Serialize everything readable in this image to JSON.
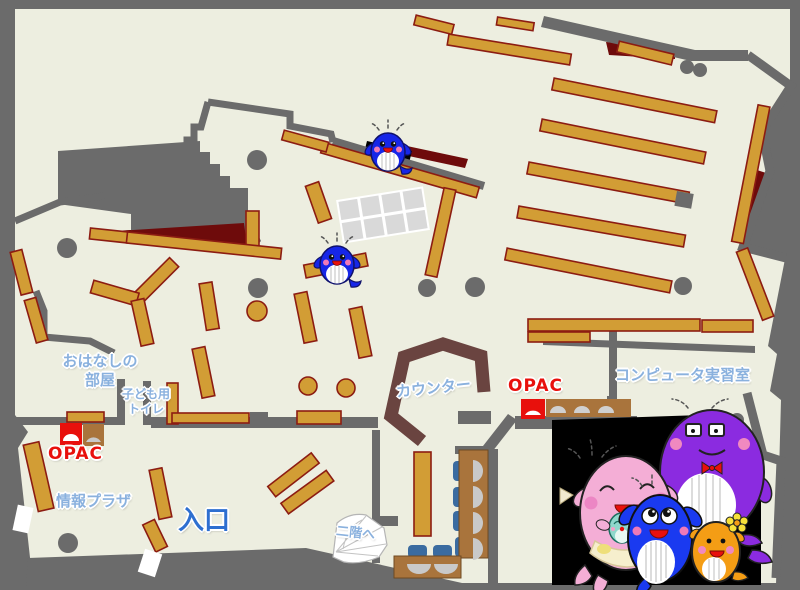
{
  "map": {
    "labels": {
      "ohanashi_line1": "おはなしの",
      "ohanashi_line2": "部屋",
      "kodomo_line1": "子ども用",
      "kodomo_line2": "トイレ",
      "opac_left": "OPAC",
      "opac_center": "OPAC",
      "joho_plaza": "情報プラザ",
      "entrance": "入口",
      "counter": "カウンター",
      "computer_room": "コンピュータ実習室",
      "to_second_floor": "二階へ"
    },
    "colors": {
      "floor": "#edeee0",
      "wall": "#6b6b6b",
      "shelf": "#d29d35",
      "shelf_border": "#8c1c12",
      "dark_red": "#6e0b0b",
      "counter": "#6a4440",
      "label_blue": "#8ab1de",
      "entrance_blue": "#2e6fd0",
      "opac_red": "#e8100c",
      "desk_brown": "#a9743c",
      "chair_blue": "#3a6ba0",
      "photo_bg": "#000000"
    },
    "mascots": {
      "on_map": [
        "blue-whale",
        "blue-whale"
      ],
      "family_photo": [
        "pink-whale-with-baby",
        "blue-whale-child",
        "purple-whale-with-glasses",
        "orange-whale-with-flower"
      ]
    }
  }
}
